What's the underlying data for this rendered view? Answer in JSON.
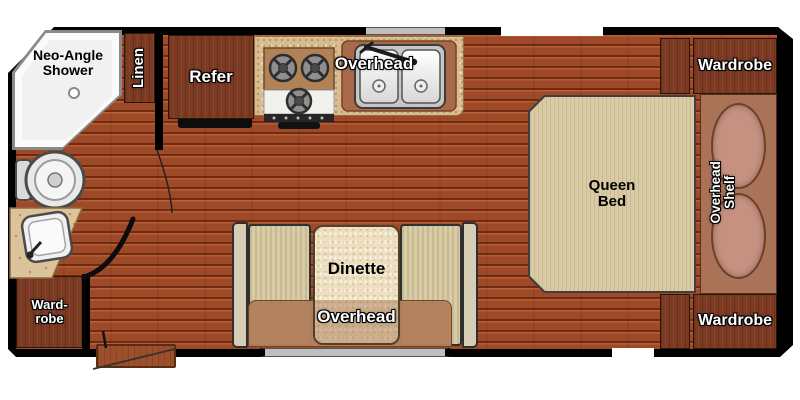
{
  "plan_type": "travel-trailer floor plan",
  "labels": {
    "shower": "Neo-Angle\nShower",
    "linen": "Linen",
    "refer": "Refer",
    "kitchen_overhead": "Overhead",
    "wardrobe_top": "Wardrobe",
    "queen_bed": "Queen\nBed",
    "overhead_shelf": "Overhead\nShelf",
    "wardrobe_bottom": "Wardrobe",
    "dinette": "Dinette",
    "dinette_overhead": "Overhead",
    "bath_wardrobe": "Ward-\nrobe"
  },
  "colors": {
    "wall": "#000000",
    "floor_hi": "#b85f36",
    "floor_light": "#9e4928",
    "floor_line": "#6e2b12",
    "cabinet": "#7c3a22",
    "counter": "#d9bc90",
    "sink_surround": "#a96a4c",
    "stove_recess": "#b28257",
    "bed": "#d8cba6",
    "bed_stripe": "#c9ba8f",
    "bench": "#d8cba8",
    "bench_stripe": "#c8b98e",
    "table": "#ecdebe",
    "band": "#b2805d",
    "panel": "#aa7257",
    "oval": "#c69180",
    "step": "#9c4f2a",
    "window_gray": "#bfbfbf",
    "shower": "#fbfbfb"
  }
}
